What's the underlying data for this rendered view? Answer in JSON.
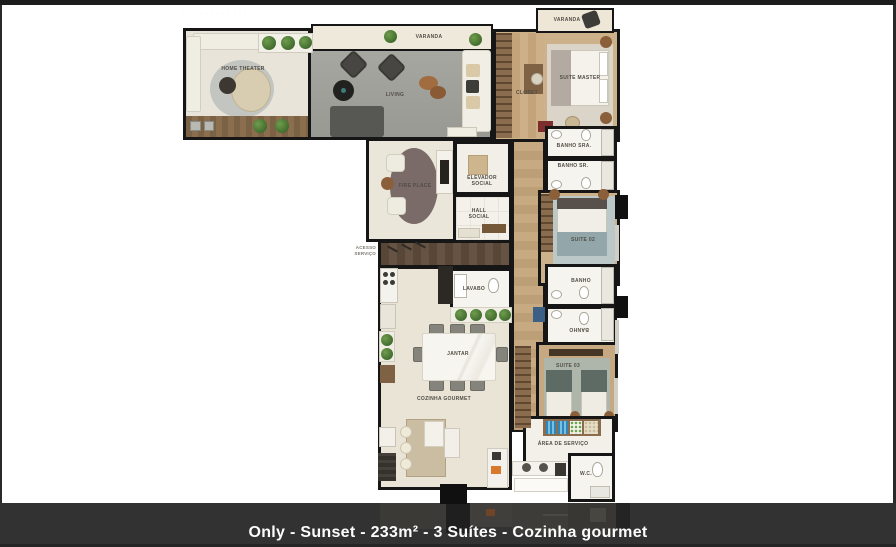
{
  "watermark": "· · · · · ·   · · · · · ·",
  "caption": "Only - Sunset - 233m² - 3 Suítes - Cozinha gourmet",
  "colors": {
    "wall": "#161616",
    "page_bg": "#ffffff",
    "top_strip": "#1c1c1c",
    "caption_bar": "#323232",
    "caption_text": "#fcfcfc",
    "wood_floor": "#cdb18b",
    "living_floor": "#a2a29c",
    "bath_floor": "#f6f4ee",
    "kitchen_floor": "#e9e4d6",
    "deck_wood": "#7c6244",
    "plant_green": "#4e7a36",
    "accent_orange": "#d8772e",
    "accent_blue": "#2e86bb",
    "accent_red": "#7c2d2c"
  },
  "rooms": {
    "home_theater": {
      "label": "HOME THEATER"
    },
    "varanda_living": {
      "label": "VARANDA"
    },
    "living": {
      "label": "LIVING"
    },
    "varanda_master": {
      "label": "VARANDA"
    },
    "suite_master": {
      "label": "SUITE MASTER"
    },
    "closet": {
      "label": "CLOSET"
    },
    "fire_place": {
      "label": "FIRE PLACE"
    },
    "elevador_social": {
      "label": "ELEVADOR\nSOCIAL"
    },
    "hall_social": {
      "label": "HALL\nSOCIAL"
    },
    "acesso_servico": {
      "label": "ACESSO\nSERVIÇO"
    },
    "lavabo": {
      "label": "LAVABO"
    },
    "banho_sra": {
      "label": "BANHO SRA."
    },
    "banho_sr": {
      "label": "BANHO SR."
    },
    "suite_02": {
      "label": "SUITE 02"
    },
    "banho_suite03_a": {
      "label": "BANHO"
    },
    "banho_suite03_b": {
      "label": "BANHO"
    },
    "suite_03": {
      "label": "SUITE 03"
    },
    "jantar": {
      "label": "JANTAR"
    },
    "cozinha_gourmet": {
      "label": "COZINHA GOURMET"
    },
    "area_servico": {
      "label": "ÁREA DE SERVIÇO"
    },
    "wc": {
      "label": "W.C."
    }
  }
}
